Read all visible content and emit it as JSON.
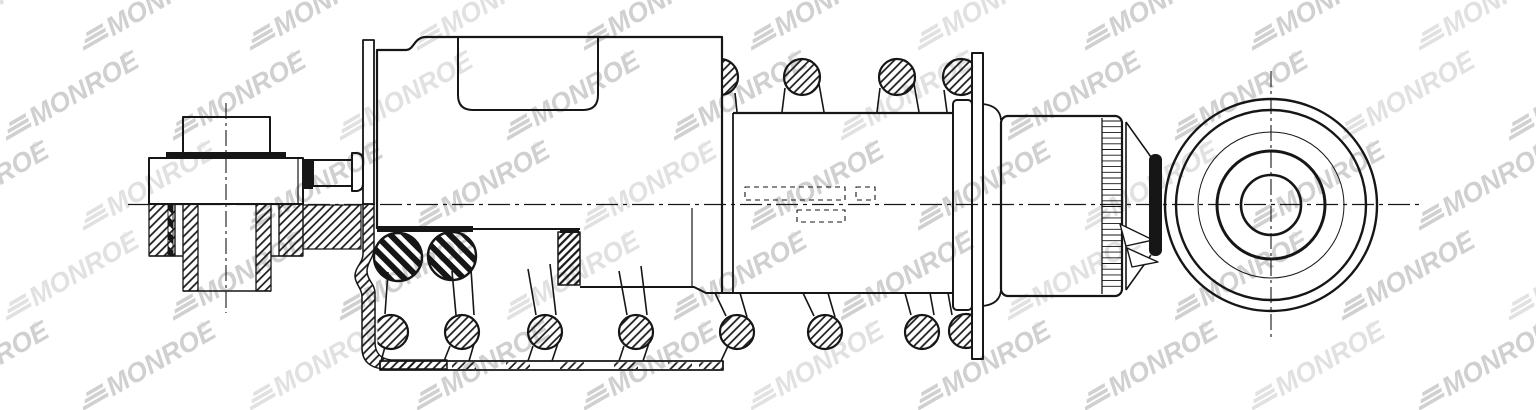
{
  "watermark": {
    "text": "MONROE",
    "registered": "®",
    "color": "#9e9e9e"
  },
  "colors": {
    "background": "#ffffff",
    "line": "#161616",
    "watermark_light": "#c9c9c9"
  }
}
